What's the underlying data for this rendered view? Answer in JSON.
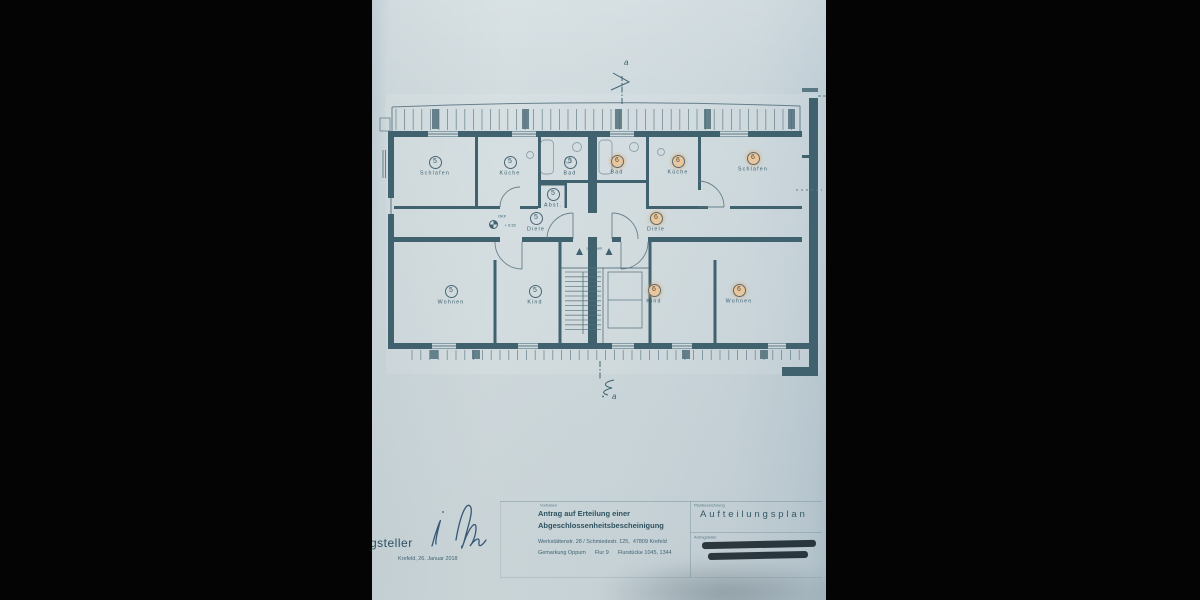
{
  "colors": {
    "wall_line": "#40626f",
    "ink": "#3a5e6d",
    "paper": "#cfdade",
    "highlight_fill": "#e9c79e",
    "redaction": "#1f2b31",
    "background": "#040404"
  },
  "plan": {
    "section_marker_letter": "a",
    "level_note_line1": "OKF",
    "level_note_line2": "+ 5.52",
    "stair_label": "Luftraum",
    "stair_count": "16",
    "rooms": [
      {
        "id": "schlafen-5",
        "num": "5",
        "label": "Schlafen",
        "x": 63,
        "y": 156,
        "hl": false
      },
      {
        "id": "kueche-5",
        "num": "5",
        "label": "Küche",
        "x": 138,
        "y": 156,
        "hl": false
      },
      {
        "id": "bad-5",
        "num": "5",
        "label": "Bad",
        "x": 198,
        "y": 156,
        "hl": false
      },
      {
        "id": "abst-5",
        "num": "5",
        "label": "Abst.",
        "x": 181,
        "y": 188,
        "hl": false
      },
      {
        "id": "diele-5",
        "num": "5",
        "label": "Diele",
        "x": 164,
        "y": 212,
        "hl": false
      },
      {
        "id": "wohnen-5",
        "num": "5",
        "label": "Wohnen",
        "x": 79,
        "y": 285,
        "hl": false
      },
      {
        "id": "kind-5",
        "num": "5",
        "label": "Kind",
        "x": 163,
        "y": 285,
        "hl": false
      },
      {
        "id": "bad-6",
        "num": "6",
        "label": "Bad",
        "x": 245,
        "y": 155,
        "hl": true
      },
      {
        "id": "kueche-6",
        "num": "6",
        "label": "Küche",
        "x": 306,
        "y": 155,
        "hl": true
      },
      {
        "id": "schlafen-6",
        "num": "6",
        "label": "Schlafen",
        "x": 381,
        "y": 152,
        "hl": true
      },
      {
        "id": "diele-6",
        "num": "6",
        "label": "Diele",
        "x": 284,
        "y": 212,
        "hl": true
      },
      {
        "id": "kind-6",
        "num": "6",
        "label": "Kind",
        "x": 282,
        "y": 284,
        "hl": true
      },
      {
        "id": "wohnen-6",
        "num": "6",
        "label": "Wohnen",
        "x": 367,
        "y": 284,
        "hl": true
      }
    ]
  },
  "title_block": {
    "applicant_partial": "gsteller",
    "date_line": "Krefeld, 26. Januar 2018",
    "project_label": "Vorhaben",
    "project_line1": "Antrag auf Erteilung einer",
    "project_line2": "Abgeschlossenheitsbescheinigung",
    "address_line": "Werkstättenstr. 28 / Schmiedestr. 125,  47809 Krefeld",
    "parcel_line": "Gemarkung Oppum      Flur 9      Flurstücke 1045, 1344",
    "plan_label": "Planbezeichnung",
    "plan_title": "Aufteilungsplan",
    "applicant_label": "Antragsteller"
  }
}
